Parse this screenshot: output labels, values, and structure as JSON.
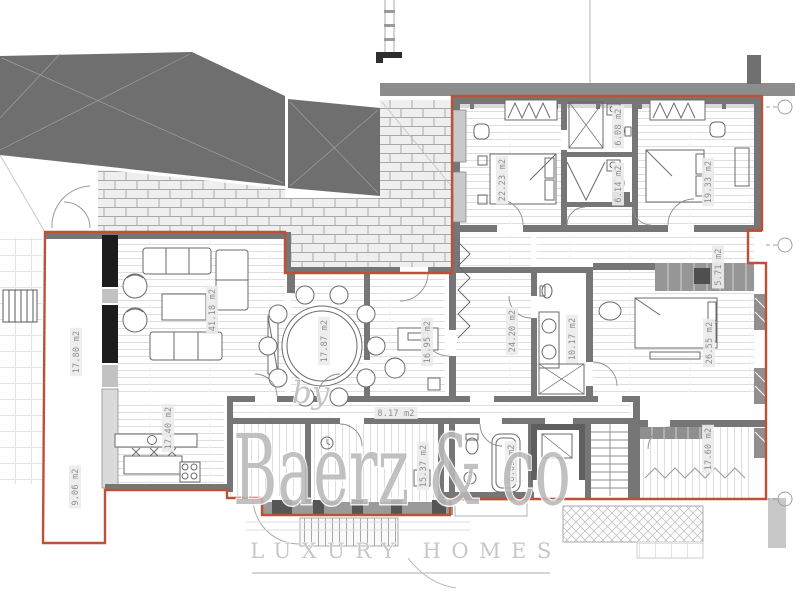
{
  "title": "apartment-floor-plan",
  "watermark": {
    "prefix": "by",
    "brand": "Baerz & co",
    "tagline": "LUXURY HOMES"
  },
  "colors": {
    "outline": "#bf5038",
    "massing": "#6f6f6f",
    "walls": "#767676",
    "brick_line": "#a8a8a8",
    "label_text": "#8f8f8f",
    "watermark": "#b9b9b9"
  },
  "rooms": [
    {
      "name": "terrace-upper-left",
      "label": "17.80 m2",
      "x": 76,
      "y": 352,
      "rot": -90
    },
    {
      "name": "terrace-lower-left",
      "label": "9.06 m2",
      "x": 75,
      "y": 487,
      "rot": -90
    },
    {
      "name": "living-room",
      "label": "41.18 m2",
      "x": 212,
      "y": 310,
      "rot": -90
    },
    {
      "name": "dining-room",
      "label": "17.87 m2",
      "x": 324,
      "y": 341,
      "rot": -90
    },
    {
      "name": "study",
      "label": "16.95 m2",
      "x": 427,
      "y": 342,
      "rot": -90
    },
    {
      "name": "kitchen",
      "label": "17.40 m2",
      "x": 168,
      "y": 428,
      "rot": -90
    },
    {
      "name": "corridor",
      "label": "8.17 m2",
      "x": 396,
      "y": 413,
      "rot": 0
    },
    {
      "name": "hallway",
      "label": "24.20 m2",
      "x": 512,
      "y": 331,
      "rot": -90
    },
    {
      "name": "master-bathroom",
      "label": "10.17 m2",
      "x": 572,
      "y": 339,
      "rot": -90
    },
    {
      "name": "master-bedroom",
      "label": "26.55 m2",
      "x": 709,
      "y": 343,
      "rot": -90
    },
    {
      "name": "dressing",
      "label": "5.71 m2",
      "x": 718,
      "y": 267,
      "rot": -90
    },
    {
      "name": "bedroom-1",
      "label": "22.23 m2",
      "x": 502,
      "y": 180,
      "rot": -90
    },
    {
      "name": "bathroom-1",
      "label": "6.08 m2",
      "x": 618,
      "y": 127,
      "rot": -90
    },
    {
      "name": "bathroom-2",
      "label": "6.14 m2",
      "x": 618,
      "y": 184,
      "rot": -90
    },
    {
      "name": "bedroom-2",
      "label": "19.33 m2",
      "x": 708,
      "y": 182,
      "rot": -90
    },
    {
      "name": "bedroom-3",
      "label": "17.60 m2",
      "x": 708,
      "y": 449,
      "rot": -90
    },
    {
      "name": "entry-hall",
      "label": "15.37 m2",
      "x": 423,
      "y": 466,
      "rot": -90
    },
    {
      "name": "guest-bathroom",
      "label": "6.05 m2",
      "x": 511,
      "y": 463,
      "rot": -90
    }
  ]
}
